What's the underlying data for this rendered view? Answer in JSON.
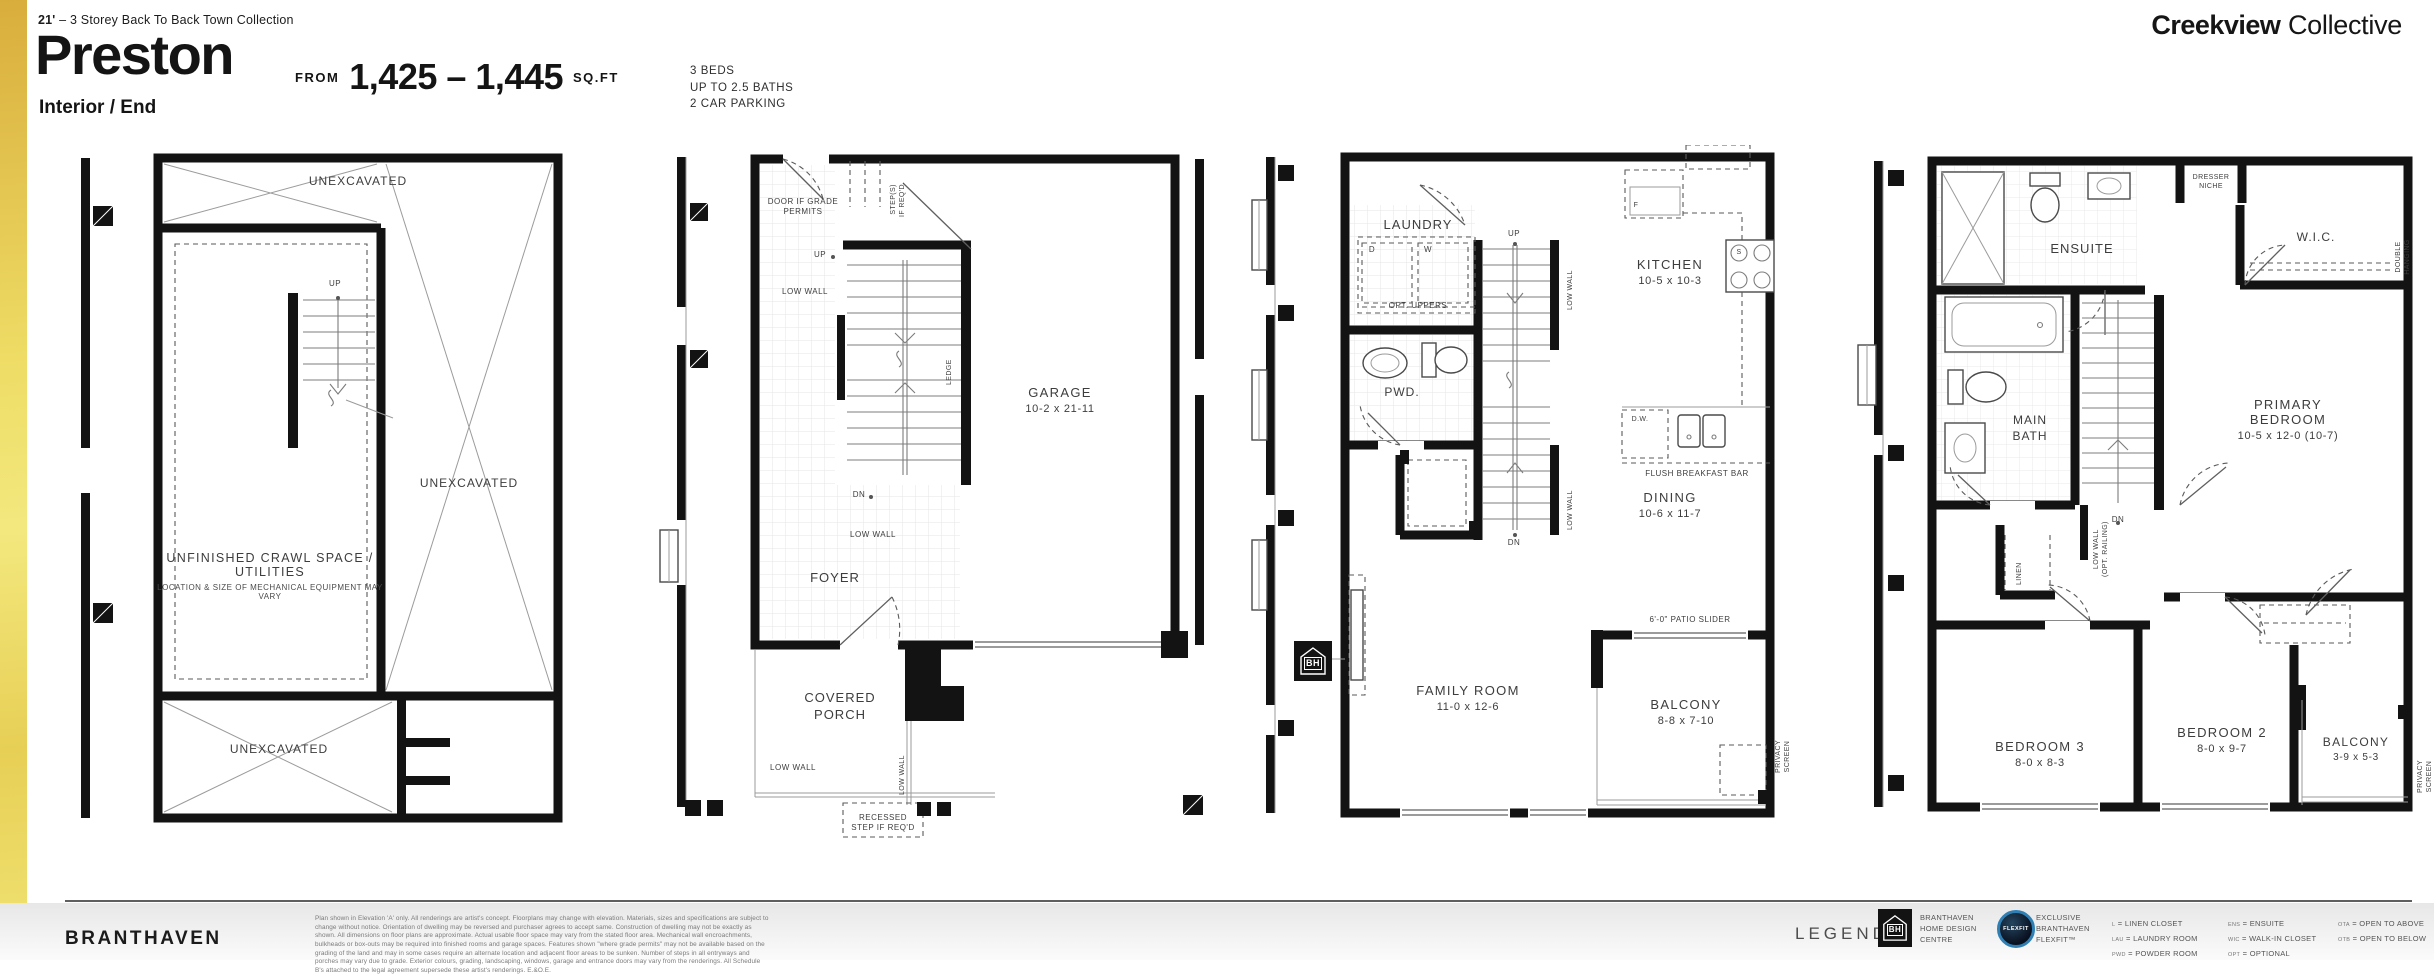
{
  "header": {
    "collection_bold": "21'",
    "collection_rest": " – 3 Storey Back To Back Town Collection",
    "plan_name": "Preston",
    "variant": "Interior / End",
    "from_label": "FROM",
    "sqft_range": "1,425 – 1,445",
    "sqft_unit": "SQ.FT",
    "specs": {
      "beds": "3 BEDS",
      "baths": "UP TO 2.5 BATHS",
      "parking": "2 CAR PARKING"
    },
    "brand_bold": "Creekview",
    "brand_light": "Collective"
  },
  "plans": {
    "basement": {
      "unexcavated_top": "UNEXCAVATED",
      "unexcavated_right": "UNEXCAVATED",
      "unexcavated_bottom": "UNEXCAVATED",
      "crawl_name": "UNFINISHED CRAWL\nSPACE / UTILITIES",
      "crawl_note": "LOCATION & SIZE OF MECHANICAL\nEQUIPMENT MAY VARY",
      "up": "UP"
    },
    "ground": {
      "door_grade": "DOOR IF GRADE\nPERMITS",
      "steps": "STEP(S)\nIF REQ'D.",
      "up": "UP",
      "dn": "DN",
      "low_wall": "LOW WALL",
      "ledge": "LEDGE",
      "foyer": "FOYER",
      "garage_name": "GARAGE",
      "garage_dim": "10-2 x 21-11",
      "porch": "COVERED\nPORCH",
      "recessed": "RECESSED\nSTEP IF REQ'D"
    },
    "main": {
      "laundry": "LAUNDRY",
      "d": "D",
      "w": "W",
      "opt_uppers": "OPT. UPPERS",
      "up": "UP",
      "dn": "DN",
      "low_wall": "LOW WALL",
      "kitchen_name": "KITCHEN",
      "kitchen_dim": "10-5 x 10-3",
      "f": "F",
      "s": "S",
      "dw": "D.W.",
      "flush_bar": "FLUSH BREAKFAST BAR",
      "pwd": "PWD.",
      "dining_name": "DINING",
      "dining_dim": "10-6 x 11-7",
      "family_name": "FAMILY ROOM",
      "family_dim": "11-0 x 12-6",
      "patio": "6'-0\" PATIO SLIDER",
      "balcony_name": "BALCONY",
      "balcony_dim": "8-8 x 7-10",
      "privacy": "PRIVACY SCREEN",
      "bh": "BH"
    },
    "upper": {
      "ensuite": "ENSUITE",
      "dresser": "DRESSER\nNICHE",
      "wic": "W.I.C.",
      "double_hanging": "DOUBLE HANGING",
      "main_bath": "MAIN\nBATH",
      "primary_name": "PRIMARY BEDROOM",
      "primary_dim": "10-5 x 12-0 (10-7)",
      "linen": "LINEN",
      "low_wall_opt": "LOW WALL\n(OPT. RAILING)",
      "dn": "DN",
      "bed3_name": "BEDROOM 3",
      "bed3_dim": "8-0 x 8-3",
      "bed2_name": "BEDROOM 2",
      "bed2_dim": "8-0 x 9-7",
      "balcony_name": "BALCONY",
      "balcony_dim": "3-9 x 5-3",
      "privacy": "PRIVACY SCREEN"
    }
  },
  "footer": {
    "logo_a": "BRANT",
    "logo_b": "HAVEN",
    "disclaimer": "Plan shown in Elevation 'A' only. All renderings are artist's concept. Floorplans may change with elevation. Materials, sizes and specifications are subject to change without notice. Orientation of dwelling may be reversed and purchaser agrees to accept same. Construction of dwelling may not be exactly as shown. All dimensions on floor plans are approximate. Actual usable floor space may vary from the stated floor area. Mechanical wall encroachments, bulkheads or box-outs may be required into finished rooms and garage spaces. Features shown \"where grade permits\" may not be available based on the grading of the land and may in some cases require an alternate location and adjacent floor areas to be sunken. Number of steps in all entryways and porches may vary due to grade. Exterior colours, grading, landscaping, windows, garage and entrance doors may vary from the renderings. All Schedule B's attached to the legal agreement supersede these artist's renderings. E.&O.E.",
    "legend_label": "LEGEND",
    "bh_badge": "BH",
    "bh_caption": "BRANTHAVEN\nHOME DESIGN\nCENTRE",
    "flexfit_badge": "FLEXFIT",
    "flexfit_caption": "EXCLUSIVE\nBRANTHAVEN\nFLEXFIT™",
    "legend_eq": "=",
    "legend_items": [
      {
        "abbr": "L",
        "label": "LINEN CLOSET"
      },
      {
        "abbr": "LAU",
        "label": "LAUNDRY ROOM"
      },
      {
        "abbr": "PWD",
        "label": "POWDER ROOM"
      },
      {
        "abbr": "ENS",
        "label": "ENSUITE"
      },
      {
        "abbr": "WIC",
        "label": "WALK-IN CLOSET"
      },
      {
        "abbr": "OPT",
        "label": "OPTIONAL"
      },
      {
        "abbr": "OTA",
        "label": "OPEN TO ABOVE"
      },
      {
        "abbr": "OTB",
        "label": "OPEN TO BELOW"
      }
    ]
  },
  "colors": {
    "accent_gold": "#e9d45a",
    "wall": "#131313",
    "label": "#3d3d3d",
    "flexfit_ring": "#2f7fb5"
  }
}
